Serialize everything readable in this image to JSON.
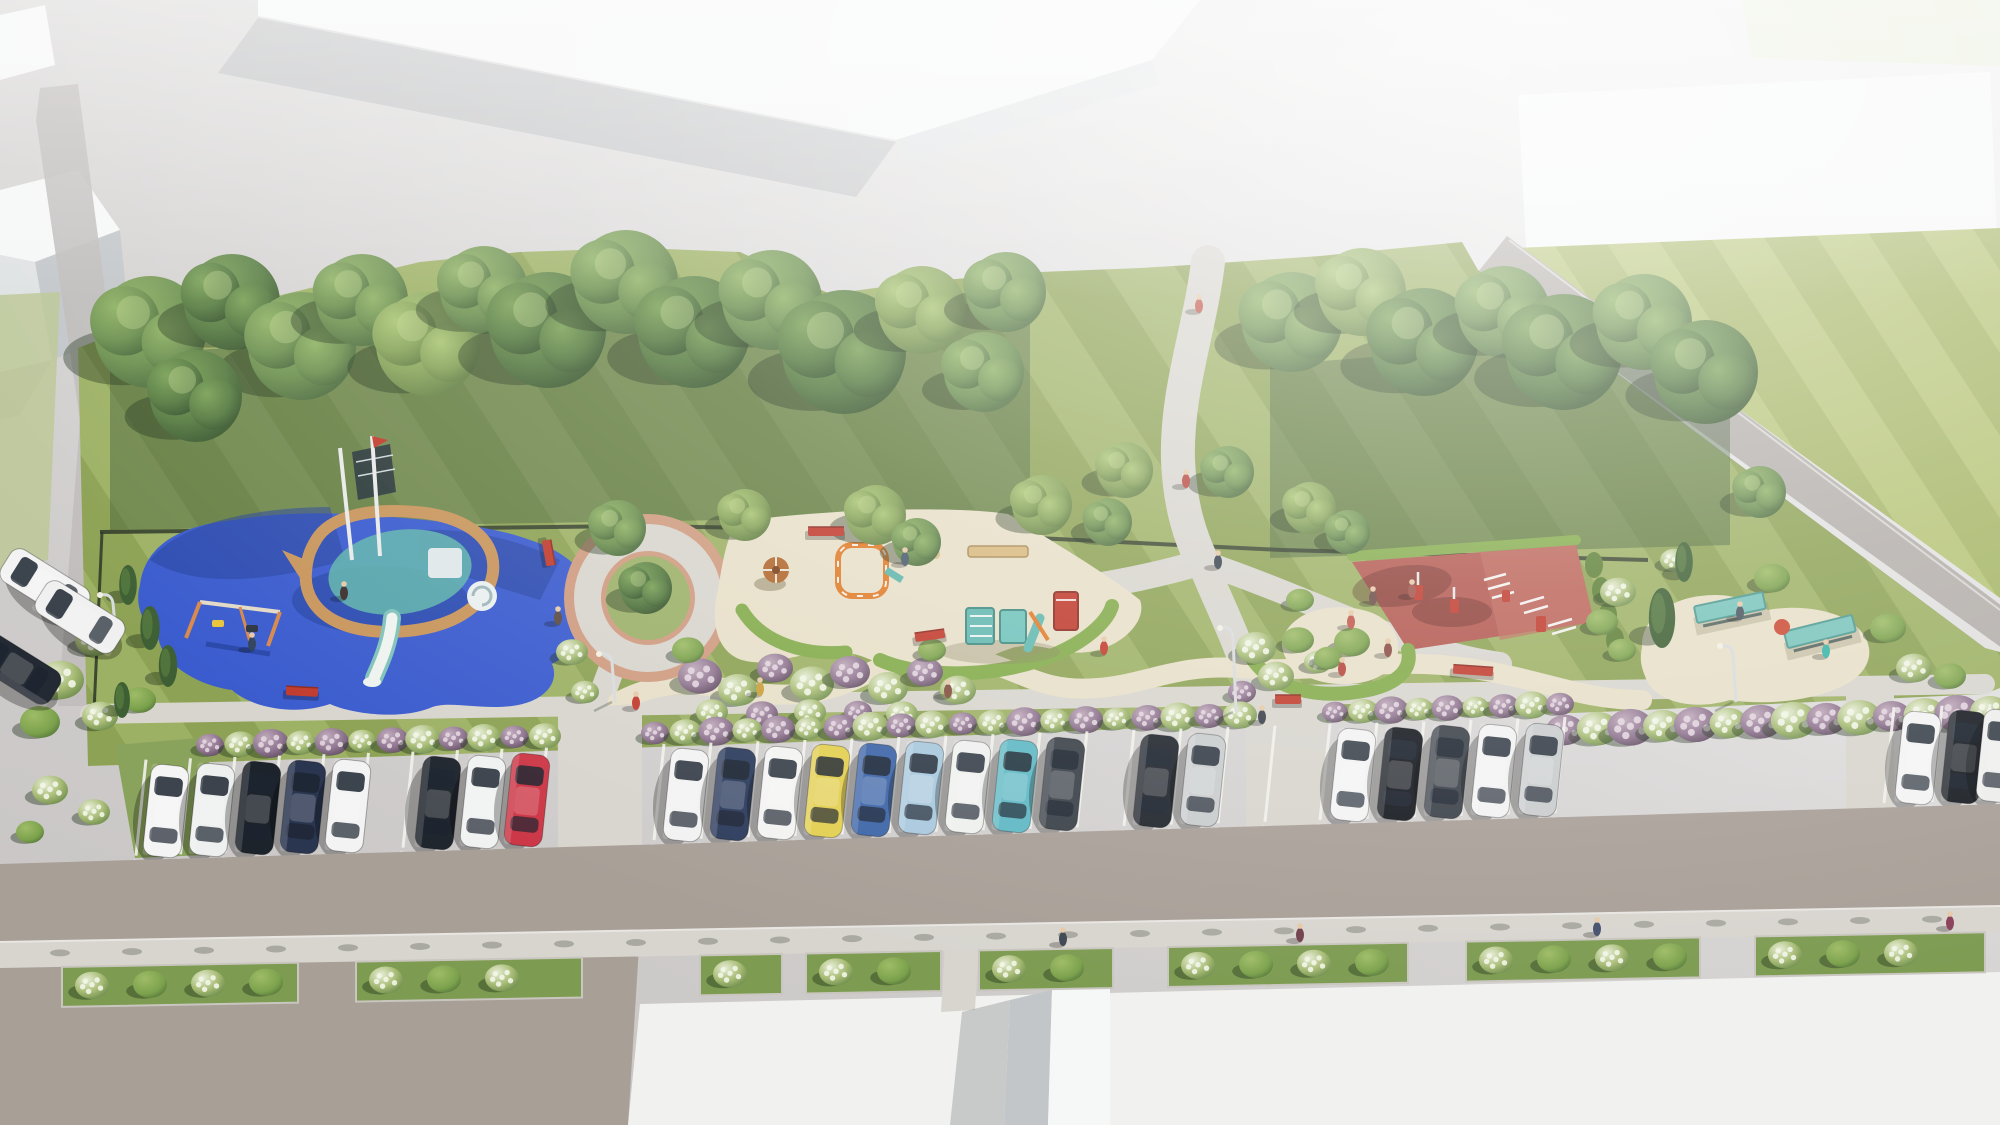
{
  "palette": {
    "pavement": "#c9c6c5",
    "pavement_light": "#ebebea",
    "building_roof": "#f6f7f7",
    "building_face": "#c2c6c9",
    "building_face_light": "#dfe2e3",
    "lawn_a": "#9db164",
    "lawn_b": "#8da254",
    "lawn_c": "#b6c477",
    "lawn_d": "#a6b667",
    "lawn_pale": "#bcc795",
    "canopy_dark": "#3c5832",
    "rubber_blue": "#3a5bce",
    "rubber_blue_dark": "#24419b",
    "sand": "#e7dfc8",
    "path": "#d8d5ce",
    "plaza_ring": "#cf9b80",
    "court_red": "#b2574e",
    "court_red_light": "#c06a5d",
    "hedge": "#83ab4a",
    "fence": "#2c3626",
    "road": "#a89f97",
    "sidewalk": "#d8d5cf",
    "bed_green": "#7d9b51",
    "white_pavement": "#f1f1ef",
    "teal": "#5fb5ac",
    "bench_red": "#c13a2c",
    "wood": "#c8955b",
    "tree_shadow": "rgba(30,48,26,0.4)"
  },
  "scene": {
    "trees": [
      [
        150,
        332,
        56,
        1
      ],
      [
        232,
        302,
        48,
        2
      ],
      [
        302,
        346,
        54,
        1
      ],
      [
        196,
        396,
        46,
        2
      ],
      [
        362,
        300,
        46,
        1
      ],
      [
        428,
        344,
        52,
        0
      ],
      [
        484,
        290,
        44,
        1
      ],
      [
        548,
        330,
        58,
        2
      ],
      [
        626,
        282,
        52,
        1
      ],
      [
        694,
        332,
        56,
        2
      ],
      [
        772,
        300,
        50,
        1
      ],
      [
        844,
        352,
        62,
        2
      ],
      [
        922,
        310,
        44,
        0
      ],
      [
        984,
        372,
        40,
        1
      ],
      [
        1006,
        292,
        40,
        1
      ],
      [
        1292,
        322,
        50,
        1
      ],
      [
        1362,
        292,
        44,
        0
      ],
      [
        1424,
        342,
        54,
        2
      ],
      [
        1504,
        312,
        46,
        1
      ],
      [
        1564,
        352,
        58,
        2
      ],
      [
        1644,
        322,
        48,
        1
      ],
      [
        1706,
        372,
        52,
        2
      ],
      [
        1125,
        470,
        28,
        0
      ],
      [
        1228,
        472,
        26,
        1
      ],
      [
        618,
        528,
        28,
        1
      ],
      [
        745,
        515,
        26,
        0
      ],
      [
        876,
        515,
        30,
        0
      ],
      [
        917,
        542,
        24,
        1
      ],
      [
        1042,
        505,
        30,
        0
      ],
      [
        1108,
        522,
        24,
        1
      ],
      [
        1310,
        508,
        26,
        0
      ],
      [
        1348,
        532,
        22,
        1
      ],
      [
        1760,
        492,
        26,
        1
      ],
      [
        646,
        588,
        26,
        2
      ]
    ],
    "conifers": [
      [
        128,
        585,
        40
      ],
      [
        150,
        628,
        44
      ],
      [
        168,
        666,
        42
      ],
      [
        122,
        700,
        36
      ],
      [
        1662,
        618,
        60
      ],
      [
        1684,
        562,
        40
      ]
    ],
    "bushes": [
      [
        95,
        640,
        20,
        "w"
      ],
      [
        60,
        680,
        24,
        "w"
      ],
      [
        100,
        716,
        18,
        "w"
      ],
      [
        40,
        722,
        20,
        "g"
      ],
      [
        140,
        700,
        16,
        "g"
      ],
      [
        572,
        652,
        16,
        "w"
      ],
      [
        585,
        692,
        14,
        "w"
      ],
      [
        700,
        676,
        22,
        "p"
      ],
      [
        738,
        690,
        20,
        "w"
      ],
      [
        775,
        668,
        18,
        "p"
      ],
      [
        812,
        684,
        22,
        "w"
      ],
      [
        850,
        672,
        20,
        "p"
      ],
      [
        888,
        688,
        20,
        "w"
      ],
      [
        925,
        672,
        18,
        "p"
      ],
      [
        958,
        690,
        18,
        "w"
      ],
      [
        712,
        712,
        16,
        "w"
      ],
      [
        762,
        714,
        16,
        "p"
      ],
      [
        810,
        712,
        16,
        "w"
      ],
      [
        858,
        712,
        14,
        "p"
      ],
      [
        902,
        714,
        16,
        "w"
      ],
      [
        688,
        650,
        16,
        "g"
      ],
      [
        932,
        650,
        14,
        "g"
      ],
      [
        1256,
        648,
        20,
        "w"
      ],
      [
        1276,
        676,
        18,
        "w"
      ],
      [
        1242,
        692,
        14,
        "p"
      ],
      [
        1298,
        640,
        16,
        "g"
      ],
      [
        1318,
        662,
        14,
        "w"
      ],
      [
        1618,
        592,
        18,
        "w"
      ],
      [
        1602,
        622,
        16,
        "g"
      ],
      [
        1772,
        578,
        18,
        "g"
      ],
      [
        1888,
        628,
        18,
        "g"
      ],
      [
        1914,
        668,
        18,
        "w"
      ],
      [
        1674,
        560,
        14,
        "w"
      ],
      [
        1622,
        650,
        14,
        "g"
      ],
      [
        1352,
        642,
        18,
        "g"
      ],
      [
        1328,
        658,
        14,
        "g"
      ],
      [
        1300,
        600,
        14,
        "g"
      ],
      [
        50,
        790,
        18,
        "w"
      ],
      [
        94,
        812,
        16,
        "w"
      ],
      [
        30,
        832,
        14,
        "g"
      ],
      [
        1950,
        676,
        16,
        "g"
      ]
    ],
    "hedge_rows": [
      [
        210,
        745,
        545,
        736,
        12,
        14
      ],
      [
        655,
        733,
        1240,
        715,
        20,
        14
      ],
      [
        1335,
        712,
        1560,
        704,
        9,
        13
      ],
      [
        1565,
        730,
        1990,
        712,
        14,
        19
      ]
    ],
    "cars": [
      [
        166,
        811,
        6,
        "#f3f4f3"
      ],
      [
        212,
        810,
        6,
        "#eef0ef"
      ],
      [
        258,
        808,
        6,
        "#1d232b"
      ],
      [
        303,
        807,
        6,
        "#2a3550"
      ],
      [
        348,
        806,
        6,
        "#f2f3f2"
      ],
      [
        438,
        803,
        6,
        "#20262e"
      ],
      [
        483,
        802,
        6,
        "#f0f1f1"
      ],
      [
        527,
        800,
        6,
        "#cc3746"
      ],
      [
        686,
        795,
        6,
        "#f1f2f1"
      ],
      [
        733,
        794,
        6,
        "#2e3d5e"
      ],
      [
        780,
        793,
        6,
        "#f3f3f2"
      ],
      [
        827,
        791,
        6,
        "#e3cf52"
      ],
      [
        874,
        790,
        6,
        "#3f66a8"
      ],
      [
        921,
        788,
        6,
        "#a9c8dd"
      ],
      [
        968,
        787,
        6,
        "#eef0ee"
      ],
      [
        1015,
        786,
        6,
        "#5fb8c4"
      ],
      [
        1062,
        784,
        6,
        "#3a4148"
      ],
      [
        1156,
        781,
        6,
        "#20252c"
      ],
      [
        1203,
        780,
        6,
        "#c9cccd"
      ],
      [
        1353,
        775,
        6,
        "#f2f3f2"
      ],
      [
        1400,
        774,
        6,
        "#15191f"
      ],
      [
        1447,
        772,
        6,
        "#3c424a"
      ],
      [
        1494,
        771,
        6,
        "#f1f2f1"
      ],
      [
        1541,
        770,
        6,
        "#c9cccd"
      ],
      [
        1918,
        758,
        6,
        "#f2f3f2"
      ],
      [
        1964,
        757,
        6,
        "#191e24"
      ],
      [
        1999,
        756,
        6,
        "#ededec"
      ],
      [
        45,
        585,
        -58,
        "#f2f3f2"
      ],
      [
        80,
        617,
        -58,
        "#eff0ef"
      ],
      [
        16,
        668,
        -58,
        "#242a33"
      ]
    ],
    "stall_groups": [
      [
        146,
        546,
        44.5
      ],
      [
        664,
        1275,
        47
      ],
      [
        1330,
        1566,
        47
      ],
      [
        1894,
        1992,
        48
      ]
    ],
    "beds": [
      [
        62,
        298
      ],
      [
        356,
        582
      ],
      [
        700,
        782
      ],
      [
        806,
        941
      ],
      [
        979,
        1113
      ],
      [
        1168,
        1408
      ],
      [
        1466,
        1700
      ],
      [
        1755,
        1985
      ]
    ],
    "people": [
      [
        252,
        641,
        "#30435c"
      ],
      [
        344,
        590,
        "#3c2f2e"
      ],
      [
        558,
        615,
        "#5a4a43"
      ],
      [
        636,
        700,
        "#c23a2e"
      ],
      [
        905,
        556,
        "#4a5a6a"
      ],
      [
        948,
        688,
        "#814d3e"
      ],
      [
        1104,
        645,
        "#c23a2e"
      ],
      [
        1186,
        478,
        "#b5443a"
      ],
      [
        1199,
        303,
        "#c0564a"
      ],
      [
        1218,
        559,
        "#36424e"
      ],
      [
        1262,
        714,
        "#3a3f4a"
      ],
      [
        1351,
        619,
        "#c0564a"
      ],
      [
        1342,
        666,
        "#b5443a"
      ],
      [
        1388,
        647,
        "#8a4a42"
      ],
      [
        1740,
        610,
        "#4a555f"
      ],
      [
        1826,
        648,
        "#37b3a6"
      ],
      [
        760,
        686,
        "#c8a03c"
      ],
      [
        1373,
        595,
        "#6b4a44"
      ],
      [
        1412,
        588,
        "#a0524a"
      ],
      [
        1063,
        936,
        "#3f4852"
      ],
      [
        1300,
        932,
        "#703f4c"
      ],
      [
        1597,
        926,
        "#44506c"
      ],
      [
        1950,
        920,
        "#8a4058"
      ]
    ],
    "lamps": [
      [
        612,
        656,
        46
      ],
      [
        1233,
        630,
        82
      ],
      [
        1733,
        648,
        54
      ],
      [
        113,
        597,
        40
      ]
    ],
    "benches_red": [
      [
        826,
        532,
        0,
        36
      ],
      [
        548,
        553,
        80,
        26
      ],
      [
        930,
        636,
        -8,
        30
      ],
      [
        1473,
        671,
        4,
        40
      ],
      [
        302,
        692,
        3,
        32
      ],
      [
        1288,
        700,
        0,
        26
      ]
    ],
    "pergolas": [
      [
        1730,
        608,
        -12
      ],
      [
        1820,
        632,
        -14
      ]
    ]
  }
}
